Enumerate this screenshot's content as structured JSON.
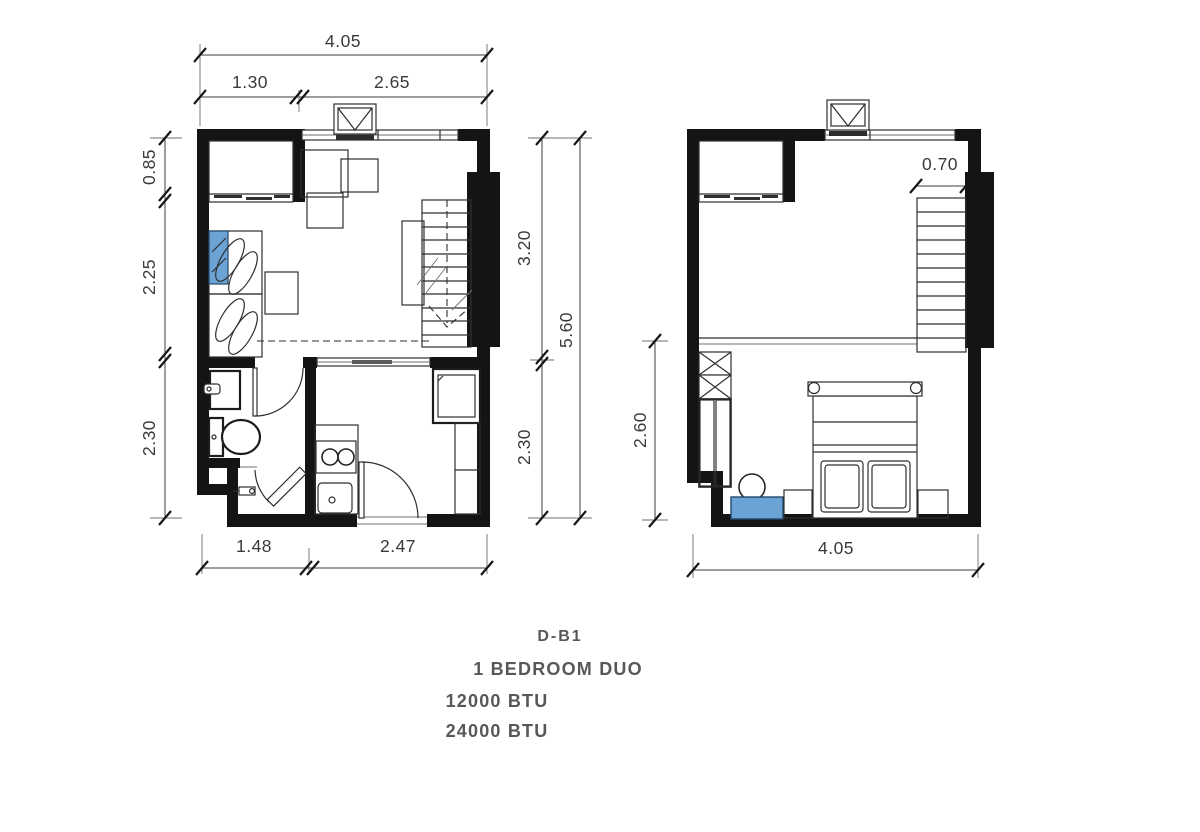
{
  "colors": {
    "wall": "#141414",
    "line": "#2e2e2e",
    "dimension_text": "#3a3a3a",
    "accent_blue": "#6ba3d4",
    "caption_text": "#57585a"
  },
  "lower_floor": {
    "dim_top_total": "4.05",
    "dim_top_left": "1.30",
    "dim_top_right": "2.65",
    "dim_left_top": "0.85",
    "dim_left_mid": "2.25",
    "dim_left_bottom": "2.30",
    "dim_right_upper": "3.20",
    "dim_right_lower": "2.30",
    "dim_right_total": "5.60",
    "dim_bottom_left": "1.48",
    "dim_bottom_right": "2.47"
  },
  "upper_floor": {
    "dim_stair_width": "0.70",
    "dim_left_height": "2.60",
    "dim_bottom_total": "4.05"
  },
  "caption": {
    "unit_code": "D-B1",
    "unit_type": "1 BEDROOM DUO",
    "btu_line1": "12000 BTU",
    "btu_line2": "24000 BTU"
  }
}
